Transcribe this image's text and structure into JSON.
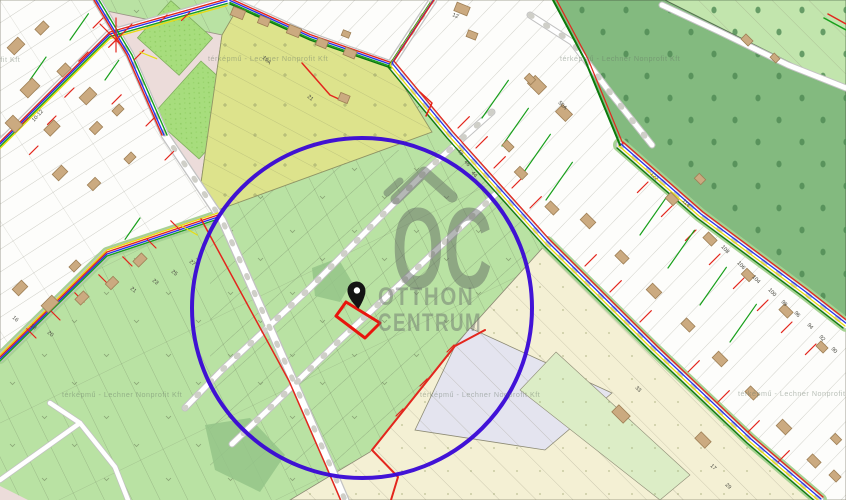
{
  "app": {
    "type": "cadastral-map-viewer",
    "description": "Cadastral utility map with highlighted search radius and pinned parcel"
  },
  "watermark": {
    "logo_text": "OC",
    "line1": "OTTHON",
    "line2": "CENTRUM"
  },
  "attribution": {
    "text": "térképmű - Lechner Nonprofit Kft",
    "tiles": [
      {
        "x": -100,
        "y": 62
      },
      {
        "x": 208,
        "y": 61
      },
      {
        "x": 560,
        "y": 61
      },
      {
        "x": 62,
        "y": 397
      },
      {
        "x": 420,
        "y": 397
      },
      {
        "x": 738,
        "y": 396
      }
    ]
  },
  "colors": {
    "highlight_circle": "#3806d6",
    "parcel_outline": "#e8150d",
    "pin": "#141414",
    "utility_red": "#e3261d",
    "utility_green": "#18a01b",
    "utility_blue": "#2633e8",
    "utility_yellow": "#e8dc12",
    "forest_green": "#83ba7f",
    "field_green": "#b9e2a3",
    "olive_field": "#dde38c",
    "watermark_gray": "#5b615e"
  },
  "map": {
    "house_numbers": [
      {
        "t": "12",
        "x": 452,
        "y": 16,
        "r": 22
      },
      {
        "t": "19A",
        "x": 262,
        "y": 58,
        "r": 42
      },
      {
        "t": "10-12",
        "x": 34,
        "y": 122,
        "r": -48
      },
      {
        "t": "21",
        "x": 307,
        "y": 97,
        "r": 42
      },
      {
        "t": "16",
        "x": 12,
        "y": 318,
        "r": 40
      },
      {
        "t": "18",
        "x": 30,
        "y": 326,
        "r": 40
      },
      {
        "t": "20",
        "x": 47,
        "y": 333,
        "r": 40
      },
      {
        "t": "21",
        "x": 130,
        "y": 289,
        "r": 40
      },
      {
        "t": "23",
        "x": 152,
        "y": 281,
        "r": 40
      },
      {
        "t": "25",
        "x": 171,
        "y": 272,
        "r": 40
      },
      {
        "t": "27",
        "x": 189,
        "y": 262,
        "r": 40
      },
      {
        "t": "50A",
        "x": 558,
        "y": 103,
        "r": 45
      },
      {
        "t": "48",
        "x": 457,
        "y": 151,
        "r": 50
      },
      {
        "t": "46",
        "x": 464,
        "y": 162,
        "r": 50
      },
      {
        "t": "44",
        "x": 471,
        "y": 173,
        "r": 50
      },
      {
        "t": "122",
        "x": 650,
        "y": 174,
        "r": 48
      },
      {
        "t": "114",
        "x": 682,
        "y": 201,
        "r": 48
      },
      {
        "t": "108",
        "x": 721,
        "y": 247,
        "r": 48
      },
      {
        "t": "106",
        "x": 737,
        "y": 263,
        "r": 48
      },
      {
        "t": "104",
        "x": 752,
        "y": 277,
        "r": 48
      },
      {
        "t": "100",
        "x": 768,
        "y": 290,
        "r": 48
      },
      {
        "t": "98",
        "x": 781,
        "y": 302,
        "r": 48
      },
      {
        "t": "96",
        "x": 794,
        "y": 313,
        "r": 48
      },
      {
        "t": "94",
        "x": 807,
        "y": 325,
        "r": 48
      },
      {
        "t": "92",
        "x": 819,
        "y": 337,
        "r": 48
      },
      {
        "t": "90",
        "x": 831,
        "y": 349,
        "r": 48
      },
      {
        "t": "33",
        "x": 635,
        "y": 388,
        "r": 45
      },
      {
        "t": "17",
        "x": 710,
        "y": 466,
        "r": 45
      },
      {
        "t": "29",
        "x": 725,
        "y": 485,
        "r": 45
      }
    ],
    "buildings": [
      {
        "x": 16,
        "y": 46,
        "w": 15,
        "h": 10,
        "r": -45
      },
      {
        "x": 42,
        "y": 28,
        "w": 12,
        "h": 8,
        "r": -45
      },
      {
        "x": 30,
        "y": 88,
        "w": 17,
        "h": 11,
        "r": -45
      },
      {
        "x": 64,
        "y": 70,
        "w": 12,
        "h": 8,
        "r": -45
      },
      {
        "x": 88,
        "y": 96,
        "w": 15,
        "h": 10,
        "r": -45
      },
      {
        "x": 14,
        "y": 124,
        "w": 11,
        "h": 14,
        "r": -45
      },
      {
        "x": 52,
        "y": 128,
        "w": 14,
        "h": 9,
        "r": -45
      },
      {
        "x": 96,
        "y": 128,
        "w": 11,
        "h": 8,
        "r": -45
      },
      {
        "x": 118,
        "y": 110,
        "w": 10,
        "h": 7,
        "r": -45
      },
      {
        "x": 60,
        "y": 173,
        "w": 13,
        "h": 9,
        "r": -45
      },
      {
        "x": 94,
        "y": 184,
        "w": 11,
        "h": 8,
        "r": -45
      },
      {
        "x": 130,
        "y": 158,
        "w": 10,
        "h": 7,
        "r": -45
      },
      {
        "x": 20,
        "y": 288,
        "w": 13,
        "h": 9,
        "r": -45
      },
      {
        "x": 50,
        "y": 304,
        "w": 15,
        "h": 10,
        "r": -45
      },
      {
        "x": 82,
        "y": 298,
        "w": 12,
        "h": 8,
        "r": -45
      },
      {
        "x": 112,
        "y": 283,
        "w": 11,
        "h": 8,
        "r": -45
      },
      {
        "x": 140,
        "y": 260,
        "w": 12,
        "h": 8,
        "r": -45
      },
      {
        "x": 75,
        "y": 266,
        "w": 10,
        "h": 7,
        "r": -45
      },
      {
        "x": 238,
        "y": 13,
        "w": 13,
        "h": 9,
        "r": 22
      },
      {
        "x": 264,
        "y": 21,
        "w": 11,
        "h": 8,
        "r": 22
      },
      {
        "x": 294,
        "y": 31,
        "w": 13,
        "h": 9,
        "r": 22
      },
      {
        "x": 322,
        "y": 43,
        "w": 11,
        "h": 8,
        "r": 22
      },
      {
        "x": 350,
        "y": 53,
        "w": 12,
        "h": 8,
        "r": 22
      },
      {
        "x": 462,
        "y": 9,
        "w": 14,
        "h": 9,
        "r": 22
      },
      {
        "x": 472,
        "y": 35,
        "w": 10,
        "h": 7,
        "r": 22
      },
      {
        "x": 344,
        "y": 98,
        "w": 10,
        "h": 8,
        "r": 22
      },
      {
        "x": 346,
        "y": 34,
        "w": 8,
        "h": 6,
        "r": 22
      },
      {
        "x": 537,
        "y": 85,
        "w": 16,
        "h": 11,
        "r": 45
      },
      {
        "x": 564,
        "y": 113,
        "w": 14,
        "h": 10,
        "r": 45
      },
      {
        "x": 508,
        "y": 146,
        "w": 10,
        "h": 7,
        "r": 45
      },
      {
        "x": 521,
        "y": 173,
        "w": 11,
        "h": 8,
        "r": 45
      },
      {
        "x": 552,
        "y": 208,
        "w": 12,
        "h": 8,
        "r": 45
      },
      {
        "x": 588,
        "y": 221,
        "w": 13,
        "h": 9,
        "r": 45
      },
      {
        "x": 622,
        "y": 257,
        "w": 12,
        "h": 8,
        "r": 45
      },
      {
        "x": 654,
        "y": 291,
        "w": 13,
        "h": 9,
        "r": 45
      },
      {
        "x": 688,
        "y": 325,
        "w": 12,
        "h": 8,
        "r": 45
      },
      {
        "x": 720,
        "y": 359,
        "w": 13,
        "h": 9,
        "r": 45
      },
      {
        "x": 752,
        "y": 393,
        "w": 12,
        "h": 8,
        "r": 45
      },
      {
        "x": 784,
        "y": 427,
        "w": 13,
        "h": 9,
        "r": 45
      },
      {
        "x": 814,
        "y": 461,
        "w": 12,
        "h": 8,
        "r": 45
      },
      {
        "x": 672,
        "y": 199,
        "w": 11,
        "h": 8,
        "r": 45
      },
      {
        "x": 710,
        "y": 239,
        "w": 12,
        "h": 8,
        "r": 45
      },
      {
        "x": 748,
        "y": 275,
        "w": 11,
        "h": 8,
        "r": 45
      },
      {
        "x": 786,
        "y": 311,
        "w": 12,
        "h": 8,
        "r": 45
      },
      {
        "x": 700,
        "y": 179,
        "w": 9,
        "h": 7,
        "r": 45
      },
      {
        "x": 822,
        "y": 347,
        "w": 10,
        "h": 7,
        "r": 45
      },
      {
        "x": 836,
        "y": 439,
        "w": 9,
        "h": 7,
        "r": 45
      },
      {
        "x": 530,
        "y": 79,
        "w": 9,
        "h": 7,
        "r": 45
      },
      {
        "x": 835,
        "y": 476,
        "w": 10,
        "h": 7,
        "r": 45
      },
      {
        "x": 747,
        "y": 40,
        "w": 10,
        "h": 7,
        "r": 45
      },
      {
        "x": 775,
        "y": 58,
        "w": 8,
        "h": 6,
        "r": 45
      },
      {
        "x": 703,
        "y": 440,
        "w": 14,
        "h": 9,
        "r": 45
      },
      {
        "x": 621,
        "y": 414,
        "w": 16,
        "h": 10,
        "r": 45
      }
    ],
    "utility_branches": [
      {
        "x": 458,
        "y": 128,
        "r": -45,
        "len": 16
      },
      {
        "x": 476,
        "y": 148,
        "r": -45,
        "len": 16
      },
      {
        "x": 494,
        "y": 168,
        "r": -45,
        "len": 16
      },
      {
        "x": 512,
        "y": 188,
        "r": -45,
        "len": 16
      },
      {
        "x": 530,
        "y": 208,
        "r": -45,
        "len": 16
      },
      {
        "x": 585,
        "y": 266,
        "r": -45,
        "len": 16
      },
      {
        "x": 610,
        "y": 292,
        "r": -45,
        "len": 16
      },
      {
        "x": 640,
        "y": 322,
        "r": -45,
        "len": 16
      },
      {
        "x": 688,
        "y": 372,
        "r": -45,
        "len": 16
      },
      {
        "x": 718,
        "y": 402,
        "r": -45,
        "len": 16
      },
      {
        "x": 748,
        "y": 432,
        "r": -45,
        "len": 16
      },
      {
        "x": 778,
        "y": 462,
        "r": -45,
        "len": 16
      },
      {
        "x": 648,
        "y": 182,
        "r": 135,
        "len": 15
      },
      {
        "x": 672,
        "y": 206,
        "r": 135,
        "len": 15
      },
      {
        "x": 696,
        "y": 230,
        "r": 135,
        "len": 15
      },
      {
        "x": 720,
        "y": 254,
        "r": 135,
        "len": 15
      },
      {
        "x": 744,
        "y": 278,
        "r": 135,
        "len": 15
      },
      {
        "x": 768,
        "y": 300,
        "r": 135,
        "len": 15
      },
      {
        "x": 792,
        "y": 322,
        "r": 135,
        "len": 15
      },
      {
        "x": 816,
        "y": 344,
        "r": 135,
        "len": 15
      },
      {
        "x": 103,
        "y": 18,
        "r": 135,
        "len": 14
      },
      {
        "x": 120,
        "y": 36,
        "r": 135,
        "len": 16
      },
      {
        "x": 88,
        "y": 52,
        "r": 135,
        "len": 13
      },
      {
        "x": 134,
        "y": 60,
        "r": -45,
        "len": 14
      },
      {
        "x": 74,
        "y": 88,
        "r": 135,
        "len": 13
      },
      {
        "x": 112,
        "y": 104,
        "r": -45,
        "len": 13
      },
      {
        "x": 56,
        "y": 116,
        "r": 135,
        "len": 12
      },
      {
        "x": 146,
        "y": 126,
        "r": -45,
        "len": 12
      },
      {
        "x": 38,
        "y": 146,
        "r": 135,
        "len": 12
      },
      {
        "x": 165,
        "y": 160,
        "r": -45,
        "len": 12
      },
      {
        "x": 190,
        "y": 12,
        "r": 135,
        "len": 12
      },
      {
        "x": 160,
        "y": 22,
        "r": -45,
        "len": 10
      },
      {
        "x": 28,
        "y": 118,
        "r": 135,
        "len": 10
      },
      {
        "x": 100,
        "y": 24,
        "r": 45,
        "len": 30
      },
      {
        "x": 132,
        "y": 24,
        "r": 135,
        "len": 30
      },
      {
        "x": 116,
        "y": 18,
        "r": 90,
        "len": 34
      },
      {
        "x": 180,
        "y": 230,
        "r": -135,
        "len": 13
      },
      {
        "x": 156,
        "y": 248,
        "r": -135,
        "len": 13
      },
      {
        "x": 132,
        "y": 266,
        "r": -135,
        "len": 13
      },
      {
        "x": 108,
        "y": 284,
        "r": -135,
        "len": 13
      },
      {
        "x": 84,
        "y": 302,
        "r": -135,
        "len": 13
      },
      {
        "x": 60,
        "y": 320,
        "r": -135,
        "len": 13
      },
      {
        "x": 36,
        "y": 338,
        "r": -135,
        "len": 13
      },
      {
        "x": 447,
        "y": 352,
        "r": -45,
        "len": 10
      },
      {
        "x": 420,
        "y": 386,
        "r": -45,
        "len": 10
      },
      {
        "x": 396,
        "y": 416,
        "r": -45,
        "len": 10
      },
      {
        "x": 482,
        "y": 118,
        "r": -55,
        "len": 46,
        "c": "#18a01b"
      },
      {
        "x": 502,
        "y": 146,
        "r": -55,
        "len": 46,
        "c": "#18a01b"
      },
      {
        "x": 524,
        "y": 172,
        "r": -55,
        "len": 46,
        "c": "#18a01b"
      },
      {
        "x": 546,
        "y": 200,
        "r": -55,
        "len": 46,
        "c": "#18a01b"
      },
      {
        "x": 640,
        "y": 235,
        "r": -55,
        "len": 46,
        "c": "#18a01b"
      },
      {
        "x": 668,
        "y": 268,
        "r": -55,
        "len": 46,
        "c": "#18a01b"
      },
      {
        "x": 700,
        "y": 305,
        "r": -55,
        "len": 46,
        "c": "#18a01b"
      },
      {
        "x": 730,
        "y": 342,
        "r": -55,
        "len": 46,
        "c": "#18a01b"
      },
      {
        "x": 70,
        "y": 40,
        "r": -55,
        "len": 32,
        "c": "#18a01b"
      },
      {
        "x": 30,
        "y": 80,
        "r": -55,
        "len": 28,
        "c": "#18a01b"
      },
      {
        "x": 105,
        "y": 80,
        "r": -55,
        "len": 24,
        "c": "#18a01b"
      },
      {
        "x": 140,
        "y": 218,
        "r": 125,
        "len": 26,
        "c": "#18a01b"
      },
      {
        "x": 140,
        "y": 52,
        "r": 22,
        "len": 18,
        "c": "#e8dc12"
      },
      {
        "x": 180,
        "y": 225,
        "r": 30,
        "len": 20,
        "c": "#e8dc12"
      }
    ]
  }
}
